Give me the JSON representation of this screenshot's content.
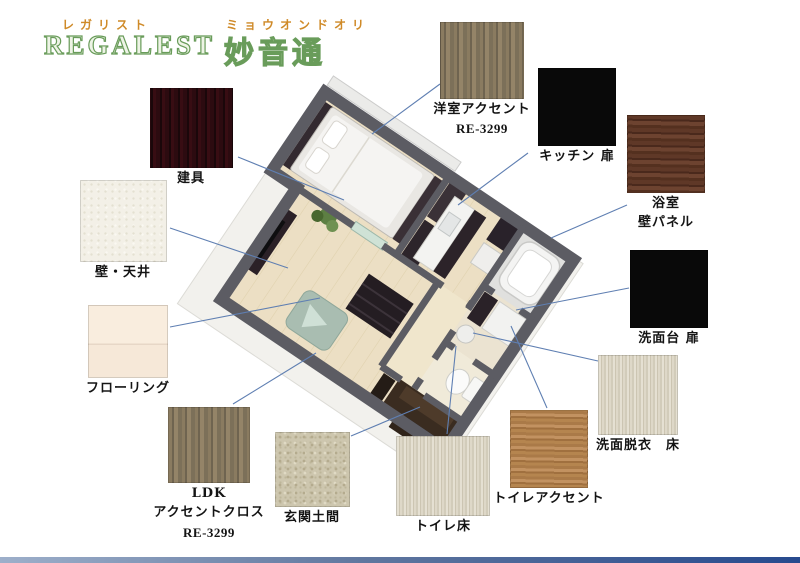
{
  "header": {
    "brand_ruby": "レガリスト",
    "brand": "REGALEST",
    "property_ruby": "ミョウオンドオリ",
    "property": "妙音通"
  },
  "swatches": [
    {
      "id": "yoshitsu-accent",
      "label": "洋室アクセント",
      "code": "RE-3299",
      "color": "#8a7b60"
    },
    {
      "id": "kitchen-door",
      "label": "キッチン 扉",
      "color": "#090909"
    },
    {
      "id": "bathroom-panel",
      "label": "浴室",
      "label2": "壁パネル",
      "color": "#5f3827"
    },
    {
      "id": "vanity-door",
      "label": "洗面台 扉",
      "color": "#090909"
    },
    {
      "id": "washroom-floor",
      "label": "洗面脱衣　床",
      "color": "#d8d2c0"
    },
    {
      "id": "toilet-accent",
      "label": "トイレアクセント",
      "color": "#b0804c"
    },
    {
      "id": "toilet-floor",
      "label": "トイレ床",
      "color": "#d8d2c0"
    },
    {
      "id": "tategu",
      "label": "建具",
      "color": "#2c0b10"
    },
    {
      "id": "wall-ceiling",
      "label": "壁・天井",
      "color": "#f3f0e7"
    },
    {
      "id": "flooring",
      "label": "フローリング",
      "color": "#f9edde"
    },
    {
      "id": "ldk-accent",
      "label": "LDK",
      "label2": "アクセントクロス",
      "code": "RE-3299",
      "color": "#8a7b60"
    },
    {
      "id": "genkan-floor",
      "label": "玄関土間",
      "color": "#cdc6ae"
    }
  ],
  "floorplan": {
    "description": "3D isometric render of 1LDK apartment (bedroom, LDK, kitchen, bath, washroom, toilet, entrance)"
  },
  "colors": {
    "accent_orange": "#cf8a28",
    "logo_green": "#699c5a",
    "annotation_blue": "#5f7fb2",
    "wall_grey": "#5c5c63",
    "floor_wood": "#ecdfc4",
    "footer_bar_left": "#9dafca",
    "footer_bar_right": "#274a8e"
  }
}
